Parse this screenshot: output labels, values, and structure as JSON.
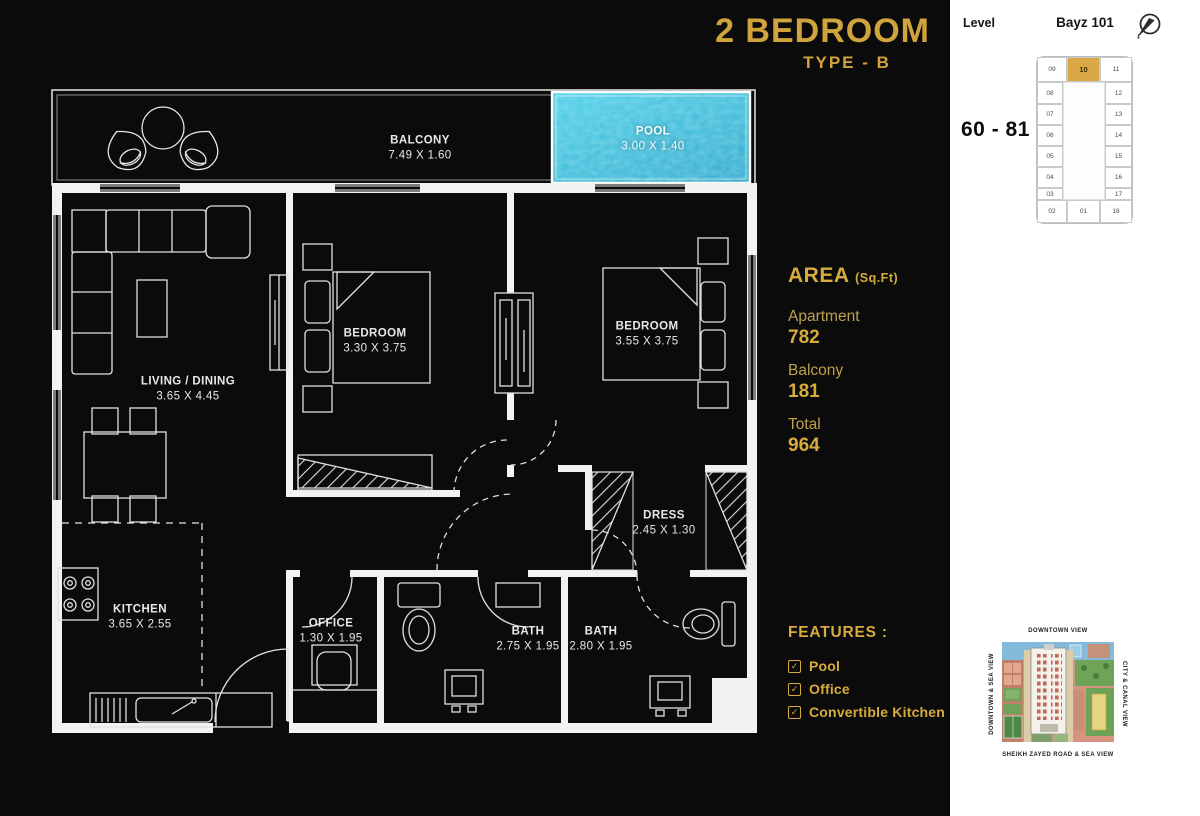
{
  "title": {
    "main": "2 BEDROOM",
    "sub": "TYPE - B"
  },
  "rooms": {
    "balcony": {
      "name": "BALCONY",
      "dims": "7.49 X 1.60"
    },
    "pool": {
      "name": "POOL",
      "dims": "3.00 X 1.40"
    },
    "living_dining": {
      "name": "LIVING / DINING",
      "dims": "3.65 X 4.45"
    },
    "bedroom_1": {
      "name": "BEDROOM",
      "dims": "3.30 X 3.75"
    },
    "bedroom_2": {
      "name": "BEDROOM",
      "dims": "3.55 X 3.75"
    },
    "kitchen": {
      "name": "KITCHEN",
      "dims": "3.65 X 2.55"
    },
    "office": {
      "name": "OFFICE",
      "dims": "1.30 X 1.95"
    },
    "bath_1": {
      "name": "BATH",
      "dims": "2.75 X 1.95"
    },
    "bath_2": {
      "name": "BATH",
      "dims": "2.80 X 1.95"
    },
    "dress": {
      "name": "DRESS",
      "dims": "2.45 X 1.30"
    }
  },
  "area_panel": {
    "heading": "AREA",
    "unit_label": "(Sq.Ft)",
    "rows": [
      {
        "label": "Apartment",
        "value": "782"
      },
      {
        "label": "Balcony",
        "value": "181"
      },
      {
        "label": "Total",
        "value": "964"
      }
    ]
  },
  "features_panel": {
    "heading": "FEATURES :",
    "checkbox_icon": "checked-checkbox",
    "items": [
      "Pool",
      "Office",
      "Convertible Kitchen"
    ]
  },
  "sidebar": {
    "level_label": "Level",
    "building_name": "Bayz 101",
    "level_range": "60 - 81",
    "compass_icon": "compass-needle-southwest",
    "unit_grid": {
      "highlighted": "10",
      "top": [
        "09",
        "10",
        "11"
      ],
      "left": [
        "08",
        "07",
        "06",
        "05",
        "04",
        "03"
      ],
      "right": [
        "12",
        "13",
        "14",
        "15",
        "16",
        "17"
      ],
      "bottom": [
        "02",
        "01",
        "18"
      ]
    },
    "site_map": {
      "top_label": "DOWNTOWN VIEW",
      "bottom_label": "SHEIKH ZAYED ROAD & SEA VIEW",
      "left_label": "DOWNTOWN & SEA VIEW",
      "right_label": "CITY & CANAL VIEW"
    }
  },
  "colors": {
    "gold": "#D0A33C",
    "gold_light_label": "#BEA14B",
    "background": "#0B0B0C",
    "sidebar_bg": "#FFFFFF",
    "pool_water": "#35BCDD",
    "highlight_unit": "#D9A845",
    "plan_lines": "#E4E4E4"
  }
}
